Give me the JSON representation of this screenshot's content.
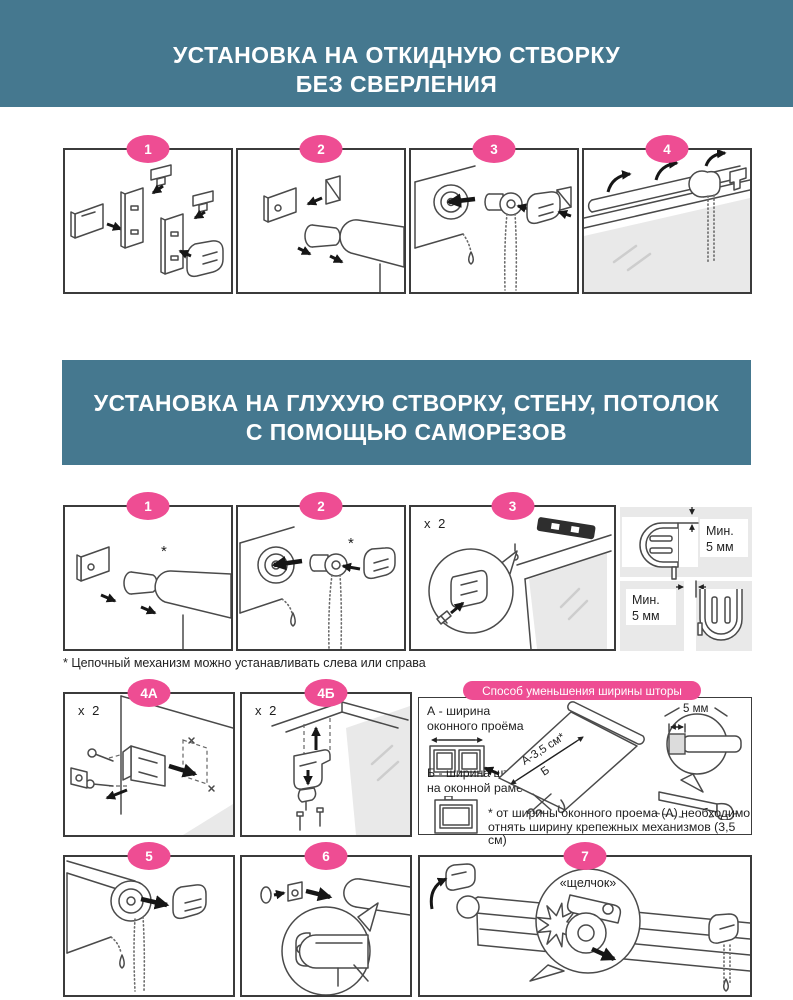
{
  "colors": {
    "banner_bg": "#45788f",
    "badge_pink": "#ee4d93",
    "border_dark": "#3b3b3b"
  },
  "banner1": {
    "line1": "УСТАНОВКА НА ОТКИДНУЮ СТВОРКУ",
    "line2": "БЕЗ СВЕРЛЕНИЯ"
  },
  "banner2": {
    "line1": "УСТАНОВКА НА ГЛУХУЮ СТВОРКУ, СТЕНУ, ПОТОЛОК",
    "line2": "С ПОМОЩЬЮ САМОРЕЗОВ"
  },
  "row1": {
    "badges": [
      "1",
      "2",
      "3",
      "4"
    ]
  },
  "row2": {
    "badges": [
      "1",
      "2",
      "3"
    ],
    "qty3": "x 2",
    "asterisk": "*",
    "clearance_top": {
      "l1": "Мин.",
      "l2": "5 мм"
    },
    "clearance_bottom": {
      "l1": "Мин.",
      "l2": "5 мм"
    }
  },
  "footnote_chain": "* Цепочный механизм можно устанавливать слева или справа",
  "row3": {
    "badge_a": "4А",
    "badge_b": "4Б",
    "qty_a": "x 2",
    "qty_b": "x 2"
  },
  "width_block": {
    "banner": "Способ уменьшения ширины шторы",
    "label_a1": "А - ширина",
    "label_a2": "оконного проёма",
    "label_b1": "Б - ширина шторы",
    "label_b2": "на оконной раме",
    "dim_a": "А-3,5 см*",
    "dim_b": "Б",
    "dim_detail": "5 мм",
    "footnote1": "* от ширины оконного проема (А) необходимо",
    "footnote2": "отнять ширину крепежных механизмов (3,5 см)"
  },
  "row4": {
    "badges": [
      "5",
      "6",
      "7"
    ],
    "click": "«щелчок»"
  }
}
